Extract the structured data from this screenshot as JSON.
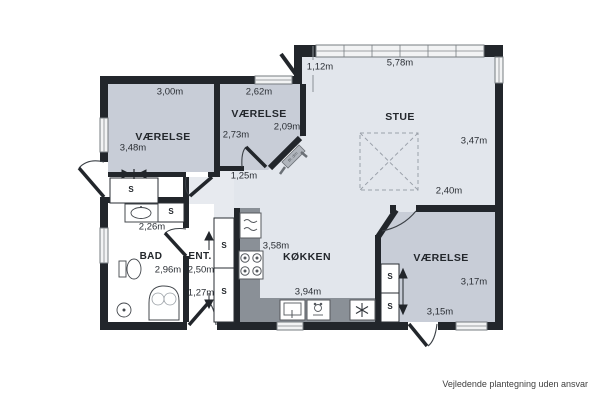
{
  "meta": {
    "footer": "Vejledende plantegning uden ansvar"
  },
  "rooms": {
    "vaerelse1": {
      "name": "VÆRELSE",
      "dim_top": "3,00m",
      "dim_left": "3,48m"
    },
    "vaerelse2": {
      "name": "VÆRELSE",
      "dim_top": "2,62m",
      "dim_left": "2,73m",
      "dim_right": "2,09m"
    },
    "stue": {
      "name": "STUE",
      "dim_top": "5,78m",
      "dim_right": "3,47m",
      "dim_offset": "1,12m"
    },
    "koekken": {
      "name": "KØKKEN",
      "dim_left": "3,58m",
      "dim_bottom": "3,94m"
    },
    "vaerelse3": {
      "name": "VÆRELSE",
      "dim_top": "2,40m",
      "dim_right": "3,17m",
      "dim_bottom": "3,15m"
    },
    "bad": {
      "name": "BAD",
      "dim_top": "2,26m",
      "dim_side": "2,96m"
    },
    "entre": {
      "name": "ENT.",
      "dim_upper": "2,50m",
      "dim_lower": "1,27m"
    },
    "corridor": {
      "dim": "1,25m"
    }
  },
  "closets": {
    "s1": "S",
    "s2": "S",
    "s3": "S",
    "s4": "S",
    "s5": "S",
    "s6": "S"
  },
  "annotations": {
    "chamfer_label": "Bl. dim"
  },
  "colors": {
    "wall": "#22262b",
    "room_fill": "#c8cdd7",
    "open_fill": "#e2e6ec",
    "counter": "#8a9097",
    "tile_line": "#e4e7eb",
    "text": "#2b2f35"
  }
}
